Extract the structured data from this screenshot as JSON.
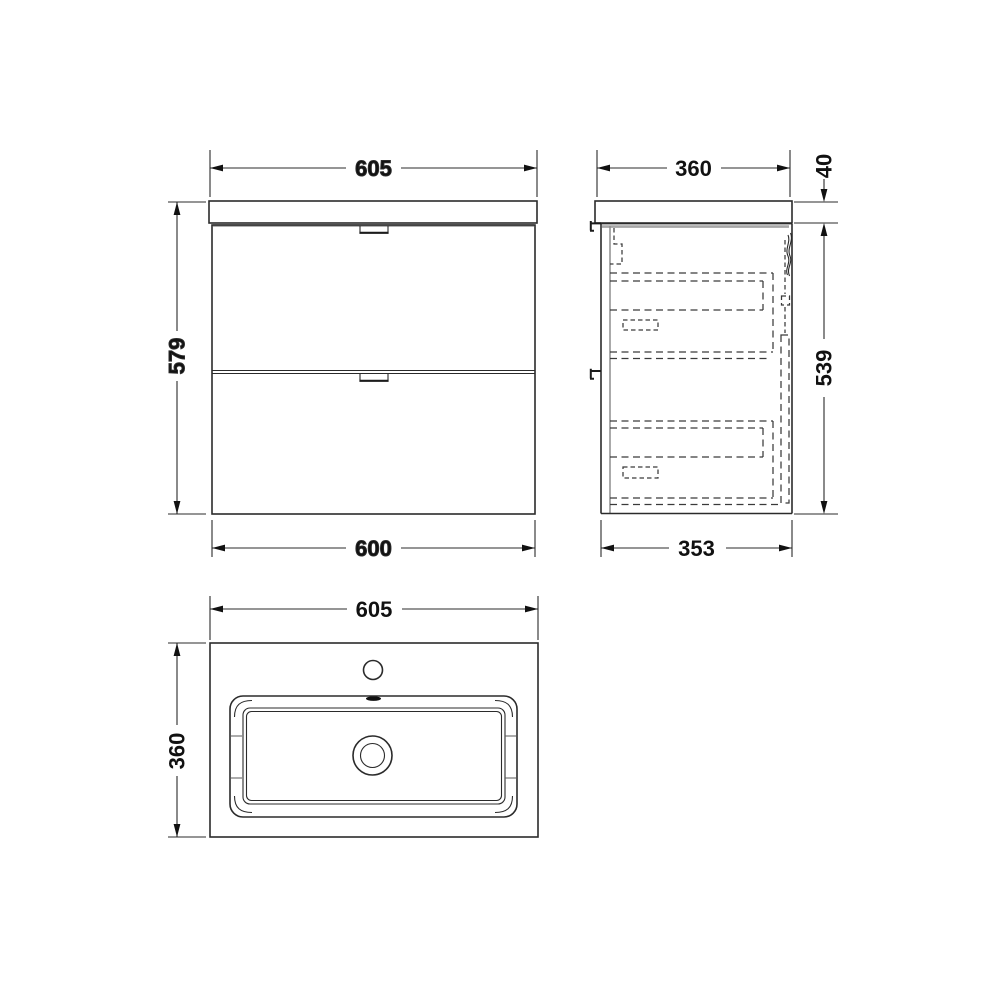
{
  "colors": {
    "background": "#ffffff",
    "line": "#2b2b2b",
    "dashed_line": "#3a3a3a",
    "shadow": "#a6a6a6",
    "text": "#111111"
  },
  "views": {
    "front": {
      "width_top": "605",
      "height_left": "579",
      "width_bottom": "600"
    },
    "side": {
      "depth_top": "360",
      "basin_thickness_right": "40",
      "cabinet_height_right": "539",
      "depth_bottom": "353"
    },
    "plan": {
      "width_top": "605",
      "depth_left": "360"
    }
  }
}
